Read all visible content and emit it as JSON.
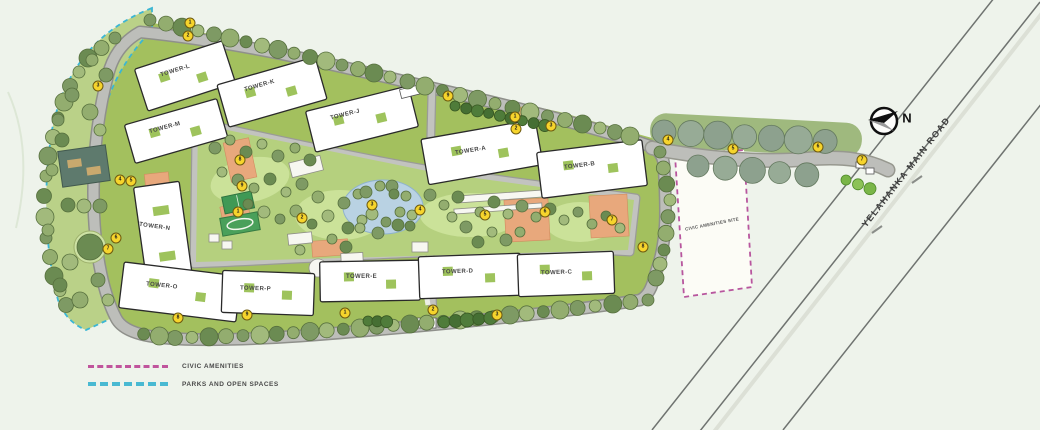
{
  "map": {
    "road_label": "YELAHANKA MAIN ROAD",
    "compass_label": "N",
    "civic_plot_label": "CIVIC AMENITIES SITE"
  },
  "legend": {
    "items": [
      {
        "label": "CIVIC AMENITIES",
        "color": "#c0549c"
      },
      {
        "label": "PARKS AND OPEN SPACES",
        "color": "#49b9d2"
      }
    ]
  },
  "towers": [
    {
      "id": "L",
      "label": "TOWER-L"
    },
    {
      "id": "K",
      "label": "TOWER-K"
    },
    {
      "id": "J",
      "label": "TOWER-J"
    },
    {
      "id": "A",
      "label": "TOWER-A"
    },
    {
      "id": "B",
      "label": "TOWER-B"
    },
    {
      "id": "M",
      "label": "TOWER-M"
    },
    {
      "id": "N",
      "label": "TOWER-N"
    },
    {
      "id": "O",
      "label": "TOWER-O"
    },
    {
      "id": "P",
      "label": "TOWER-P"
    },
    {
      "id": "E",
      "label": "TOWER-E"
    },
    {
      "id": "D",
      "label": "TOWER-D"
    },
    {
      "id": "C",
      "label": "TOWER-C"
    }
  ],
  "markers": [
    {
      "value": "1"
    },
    {
      "value": "2"
    },
    {
      "value": "3"
    },
    {
      "value": "4"
    },
    {
      "value": "5"
    },
    {
      "value": "6"
    },
    {
      "value": "7"
    },
    {
      "value": "8"
    },
    {
      "value": "9"
    },
    {
      "value": "1"
    },
    {
      "value": "2"
    },
    {
      "value": "3"
    },
    {
      "value": "4"
    },
    {
      "value": "5"
    },
    {
      "value": "6"
    },
    {
      "value": "7"
    },
    {
      "value": "8"
    },
    {
      "value": "9"
    },
    {
      "value": "1"
    },
    {
      "value": "2"
    },
    {
      "value": "3"
    },
    {
      "value": "4"
    },
    {
      "value": "5"
    },
    {
      "value": "6"
    },
    {
      "value": "7"
    },
    {
      "value": "8"
    },
    {
      "value": "9"
    },
    {
      "value": "1"
    },
    {
      "value": "2"
    },
    {
      "value": "3"
    }
  ],
  "colors": {
    "civic_boundary": "#b8569e",
    "parks_boundary": "#3bb6d4",
    "marker_fill": "#f6d42c",
    "pool": "#b9d2e3",
    "plaza": "#e8a87c"
  }
}
